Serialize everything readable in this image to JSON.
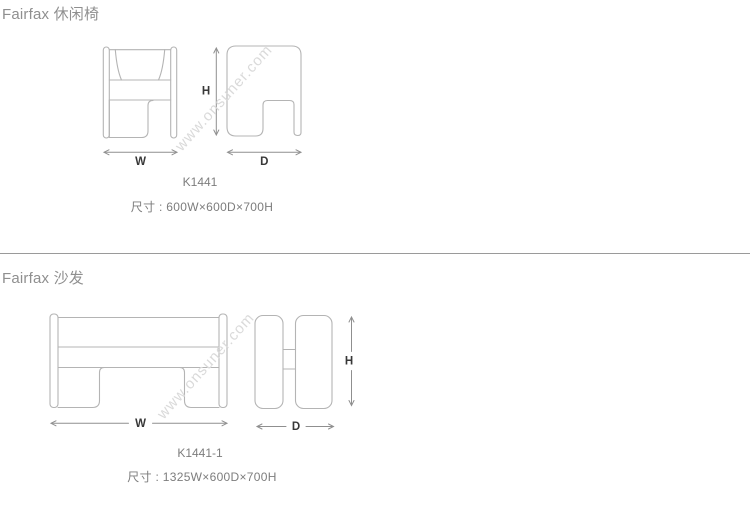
{
  "watermark": {
    "text": "www.onsuner.com"
  },
  "sections": [
    {
      "title": "Fairfax 休闲椅",
      "model": "K1441",
      "size_label": "尺寸 : 600W×600D×700H",
      "dim_labels": {
        "w": "W",
        "d": "D",
        "h": "H"
      }
    },
    {
      "title": "Fairfax 沙发",
      "model": "K1441-1",
      "size_label": "尺寸 : 1325W×600D×700H",
      "dim_labels": {
        "w": "W",
        "d": "D",
        "h": "H"
      }
    }
  ],
  "colors": {
    "drawing_line": "#b4b4b4",
    "dimension_line": "#8f8f8f",
    "dimension_label": "#383838",
    "section_title": "#8f8f8f",
    "body_text": "#7d7d7d",
    "divider": "#9a9a9a",
    "watermark": "#dadada",
    "background": "#ffffff"
  }
}
